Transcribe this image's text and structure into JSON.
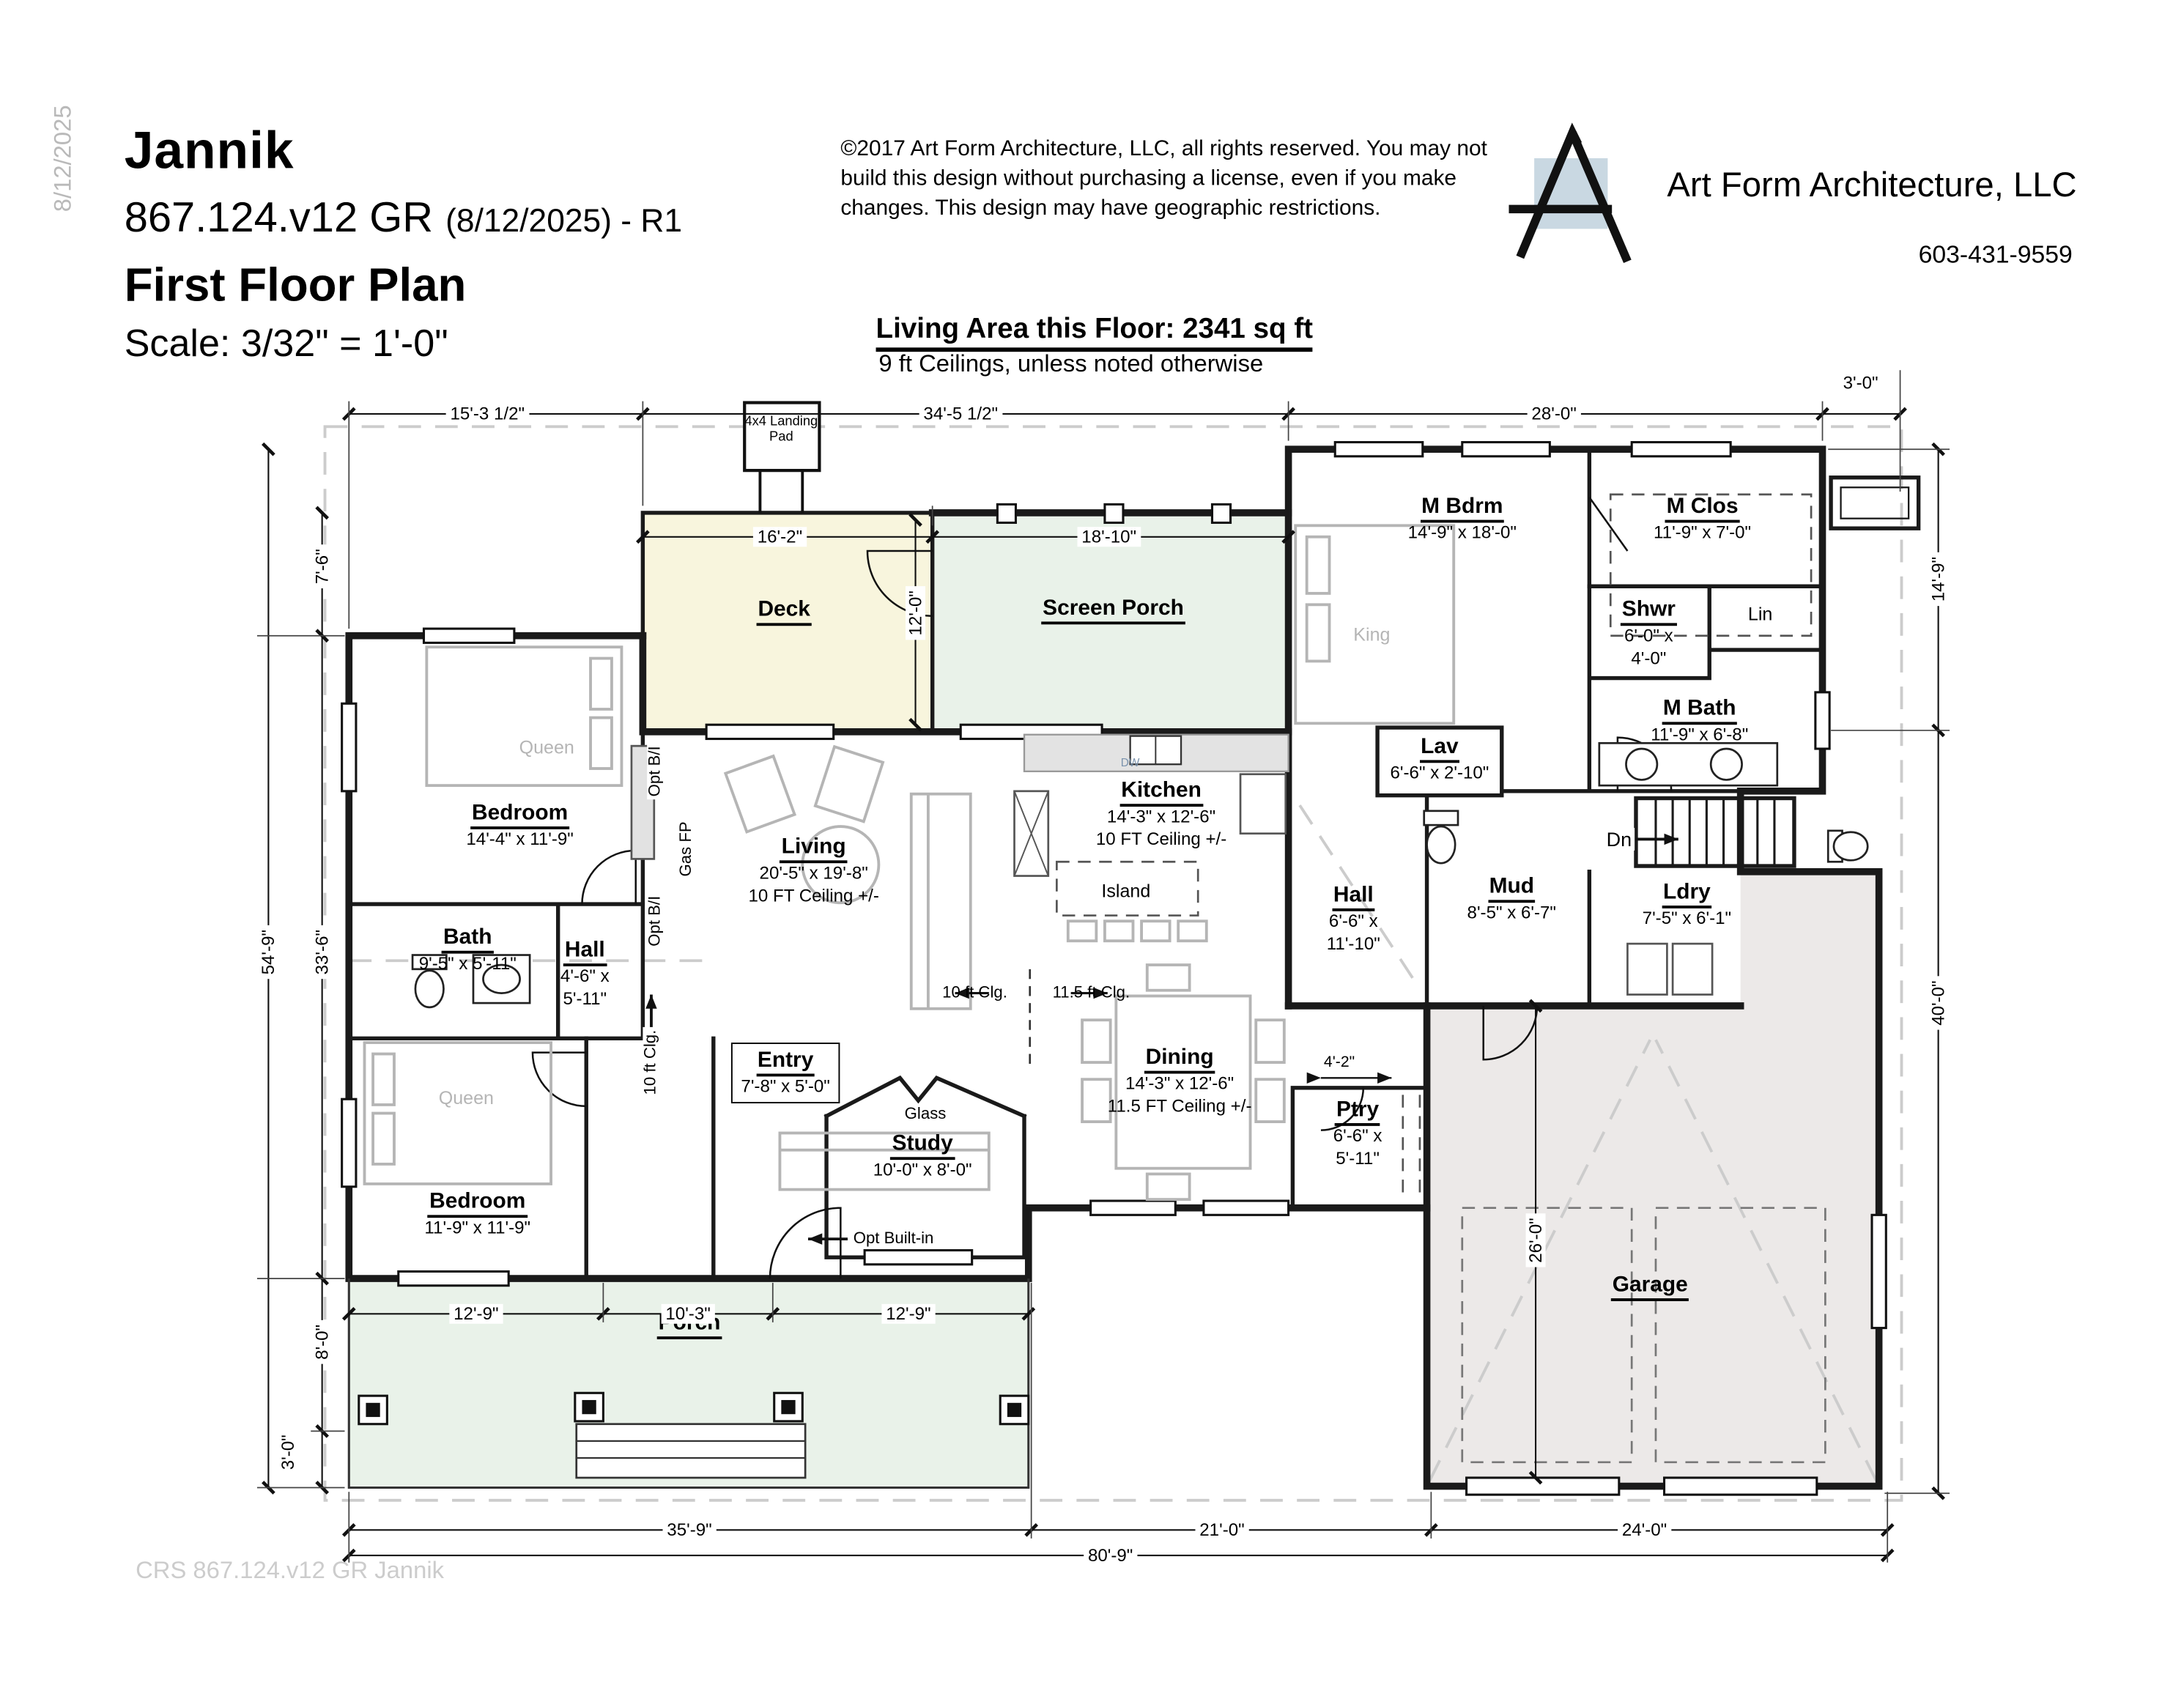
{
  "header": {
    "side_date": "8/12/2025",
    "title": "Jannik",
    "plan_no": "867.124.v12 GR",
    "revision": "(8/12/2025) - R1",
    "subtitle": "First Floor Plan",
    "scale": "Scale: 3/32\" = 1'-0\"",
    "copyright": "©2017 Art Form Architecture, LLC, all rights reserved. You may not build this design without purchasing a license, even if you make changes. This design may have geographic restrictions.",
    "firm": "Art Form Architecture, LLC",
    "phone": "603-431-9559",
    "living_area": "Living Area this Floor: 2341 sq ft",
    "ceiling_note": "9 ft Ceilings, unless noted otherwise"
  },
  "watermark": "CRS 867.124.v12 GR Jannik",
  "rooms": {
    "deck": {
      "name": "Deck"
    },
    "screen_porch": {
      "name": "Screen Porch"
    },
    "m_bdrm": {
      "name": "M Bdrm",
      "size": "14'-9\" x 18'-0\""
    },
    "m_clos": {
      "name": "M Clos",
      "size": "11'-9\" x 7'-0\""
    },
    "shwr": {
      "name": "Shwr",
      "size": "6'-0\" x",
      "size2": "4'-0\""
    },
    "lin": {
      "name": "Lin"
    },
    "m_bath": {
      "name": "M Bath",
      "size": "11'-9\" x 6'-8\""
    },
    "lav": {
      "name": "Lav",
      "size": "6'-6\" x 2'-10\""
    },
    "kitchen": {
      "name": "Kitchen",
      "size": "14'-3\" x 12'-6\"",
      "ceil": "10 FT Ceiling +/-"
    },
    "island": {
      "name": "Island"
    },
    "living": {
      "name": "Living",
      "size": "20'-5\" x 19'-8\"",
      "ceil": "10 FT Ceiling +/-"
    },
    "bedroom1": {
      "name": "Bedroom",
      "size": "14'-4\" x 11'-9\""
    },
    "bath": {
      "name": "Bath",
      "size": "9'-5\" x 5'-11\""
    },
    "hall1": {
      "name": "Hall",
      "size": "4'-6\" x",
      "size2": "5'-11\""
    },
    "hall2": {
      "name": "Hall",
      "size": "6'-6\" x",
      "size2": "11'-10\""
    },
    "mud": {
      "name": "Mud",
      "size": "8'-5\" x 6'-7\""
    },
    "ldry": {
      "name": "Ldry",
      "size": "7'-5\" x 6'-1\""
    },
    "entry": {
      "name": "Entry",
      "size": "7'-8\" x 5'-0\""
    },
    "study": {
      "name": "Study",
      "size": "10'-0\" x 8'-0\""
    },
    "dining": {
      "name": "Dining",
      "size": "14'-3\" x 12'-6\"",
      "ceil": "11.5 FT Ceiling +/-"
    },
    "ptry": {
      "name": "Ptry",
      "size": "6'-6\" x",
      "size2": "5'-11\""
    },
    "bedroom2": {
      "name": "Bedroom",
      "size": "11'-9\" x 11'-9\""
    },
    "porch": {
      "name": "Porch"
    },
    "garage": {
      "name": "Garage"
    }
  },
  "annotations": {
    "king": "King",
    "queen1": "Queen",
    "queen2": "Queen",
    "gas_fp": "Gas FP",
    "opt_bi1": "Opt B/I",
    "opt_bi2": "Opt B/I",
    "ten_clg": "10 ft Clg.",
    "clg_left": "10 ft Clg.",
    "clg_right": "11.5 ft Clg.",
    "dn": "Dn",
    "glass": "Glass",
    "opt_builtin": "Opt Built-in",
    "landing1": "4x4 Landing",
    "landing2": "Pad",
    "dw": "DW"
  },
  "dimensions": {
    "top1": "15'-3 1/2\"",
    "top2": "34'-5 1/2\"",
    "top3": "28'-0\"",
    "top4": "3'-0\"",
    "deck_w": "16'-2\"",
    "sp_w": "18'-10\"",
    "deck_h": "12'-0\"",
    "left_outer": "54'-9\"",
    "left_top": "7'-6\"",
    "left_mid": "33'-6\"",
    "left_porch": "8'-0\"",
    "left_step": "3'-0\"",
    "right_top": "14'-9\"",
    "right_bot": "40'-0\"",
    "porch1": "12'-9\"",
    "porch2": "10'-3\"",
    "porch3": "12'-9\"",
    "garage_h": "26'-0\"",
    "ptry_w": "4'-2\"",
    "bot1": "35'-9\"",
    "bot2": "21'-0\"",
    "bot3": "24'-0\"",
    "bot_total": "80'-9\""
  },
  "colors": {
    "deck_fill": "#f8f5dd",
    "porch_fill": "#e9f2e9",
    "garage_fill": "#ece9e8",
    "logo_square": "#c9d8e2",
    "wall": "#1a1a1a",
    "roof_dash": "#cccccc",
    "furniture": "#b5b5b5"
  }
}
